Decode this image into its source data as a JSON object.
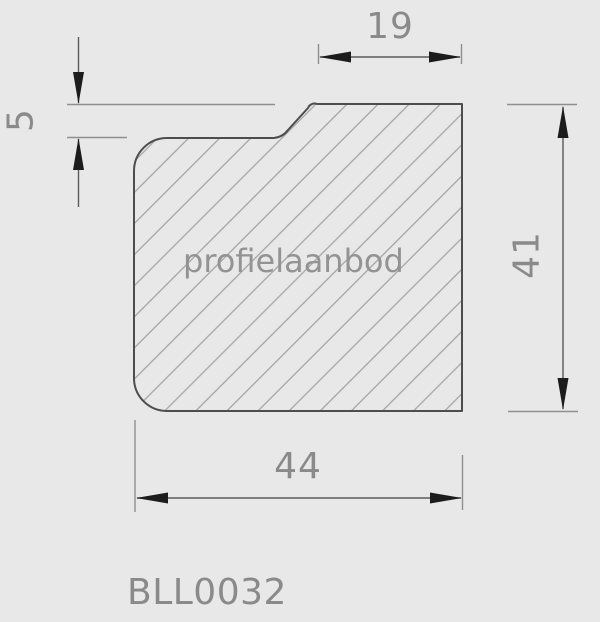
{
  "drawing": {
    "type": "technical-profile-cross-section",
    "watermark": "profielaanbod",
    "product_code": "BLL0032",
    "dimensions": {
      "top_width": "19",
      "rebate_height": "5",
      "overall_height": "41",
      "overall_width": "44"
    },
    "colors": {
      "background": "#e8e8e8",
      "profile_outline": "#4d4d4d",
      "hatch_lines": "#a2a2a2",
      "dimension_lines": "#5a5a5a",
      "extension_lines": "#8f8f8f",
      "arrowheads": "#1c1c1c",
      "text": "#8a8a8a"
    }
  }
}
